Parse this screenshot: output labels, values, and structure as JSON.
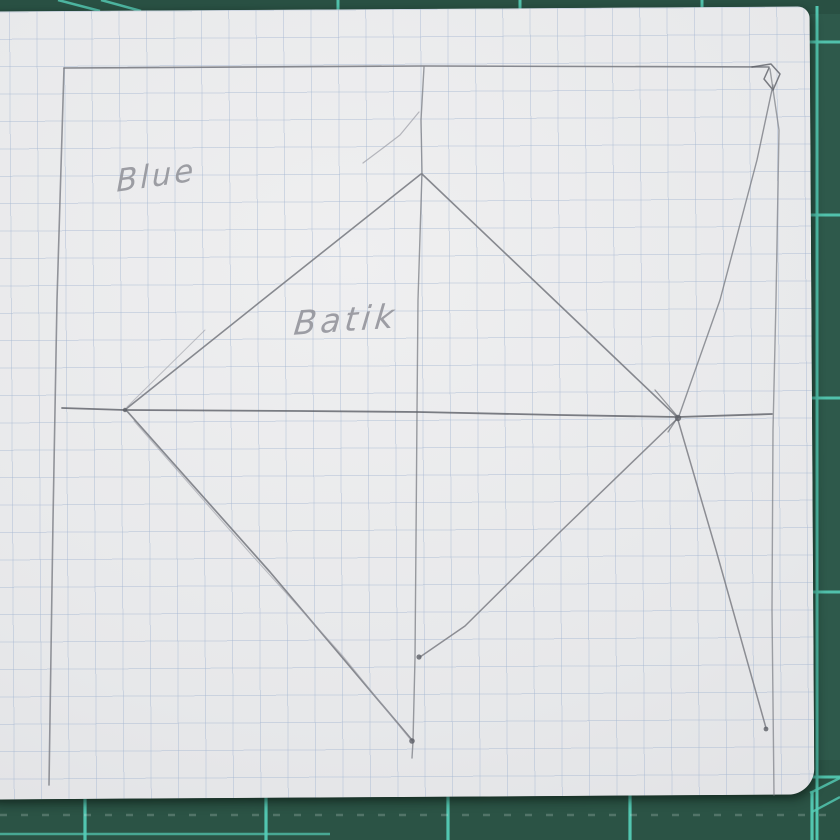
{
  "scene": {
    "width": 840,
    "height": 840,
    "description": "pencil quilt-block sketch on graph paper lying on a green cutting mat"
  },
  "mat": {
    "base_color": "#2e594b",
    "base_dark": "#24483c",
    "grid_line_color": "#55cdb6",
    "top_edge_y": 11,
    "bottom_edge_y": 797,
    "right_edge_x": 812,
    "top_ticks_x": [
      338,
      520,
      702
    ],
    "top_diagonals": [
      [
        58,
        0,
        100,
        11
      ],
      [
        101,
        0,
        141,
        11
      ]
    ],
    "bottom_ticks_x": [
      85,
      266,
      448,
      630,
      812
    ],
    "bottom_line": {
      "y": 834,
      "x1": 0,
      "x2": 330
    },
    "dash_row": {
      "y": 815,
      "x1": 0,
      "x2": 840,
      "color": "rgba(225,235,230,0.22)"
    },
    "right_rail_x": 817,
    "right_ticks_y": [
      42,
      215,
      398,
      592,
      777
    ],
    "corner_diagonals": [
      [
        810,
        793,
        840,
        778
      ],
      [
        812,
        812,
        840,
        797
      ]
    ]
  },
  "paper": {
    "x": -16,
    "y": 9,
    "w": 828,
    "h": 788,
    "rotation_deg": -0.35,
    "radius": "4px 12px 26px 12px",
    "base_color": "#e7e8ea",
    "grid_color": "rgba(163,181,208,0.42)",
    "grid_size_px": 27.4
  },
  "sketch": {
    "tones": {
      "main": "#7b7d84",
      "dark": "#5d5f66",
      "faint": "#9b9da5"
    },
    "labels": [
      {
        "text": "Blue",
        "x": 116,
        "y": 158,
        "size": 31,
        "rot": -8,
        "skew": -8,
        "ls": 3
      },
      {
        "text": "Batik",
        "x": 294,
        "y": 300,
        "size": 33,
        "rot": -4,
        "skew": -10,
        "ls": 4
      }
    ],
    "strokes": [
      {
        "name": "square-top-edge",
        "tone": "main",
        "w": 1.6,
        "o": 0.9,
        "pts": [
          [
            64,
            68
          ],
          [
            424,
            66
          ],
          [
            769,
            67
          ]
        ]
      },
      {
        "name": "square-left-edge",
        "tone": "main",
        "w": 1.6,
        "o": 0.8,
        "pts": [
          [
            64,
            68
          ],
          [
            57,
            300
          ],
          [
            53,
            520
          ],
          [
            49,
            785
          ]
        ]
      },
      {
        "name": "square-right-edge",
        "tone": "main",
        "w": 1.4,
        "o": 0.7,
        "pts": [
          [
            770,
            69
          ],
          [
            779,
            130
          ],
          [
            776,
            300
          ],
          [
            773,
            430
          ],
          [
            772,
            610
          ],
          [
            774,
            795
          ]
        ]
      },
      {
        "name": "corner-loop-scribble",
        "tone": "dark",
        "w": 1.5,
        "o": 0.8,
        "pts": [
          [
            752,
            67
          ],
          [
            771,
            64
          ],
          [
            780,
            74
          ],
          [
            773,
            90
          ],
          [
            764,
            79
          ],
          [
            769,
            68
          ]
        ]
      },
      {
        "name": "center-vertical-line",
        "tone": "main",
        "w": 1.4,
        "o": 0.75,
        "pts": [
          [
            424,
            67
          ],
          [
            421,
            120
          ],
          [
            422,
            172
          ],
          [
            418,
            300
          ],
          [
            417,
            412
          ],
          [
            416,
            540
          ],
          [
            415,
            658
          ],
          [
            413,
            741
          ],
          [
            412,
            758
          ]
        ]
      },
      {
        "name": "center-horizontal-line",
        "tone": "dark",
        "w": 1.8,
        "o": 0.8,
        "pts": [
          [
            62,
            408
          ],
          [
            125,
            410
          ],
          [
            300,
            411
          ],
          [
            418,
            412
          ],
          [
            560,
            415
          ],
          [
            678,
            417
          ],
          [
            772,
            414
          ]
        ]
      },
      {
        "name": "diamond-edge-top-left",
        "tone": "main",
        "w": 1.6,
        "o": 0.9,
        "pts": [
          [
            421,
            174
          ],
          [
            270,
            294
          ],
          [
            126,
            409
          ]
        ]
      },
      {
        "name": "diamond-edge-top-left-ghost",
        "tone": "faint",
        "w": 1.0,
        "o": 0.6,
        "pts": [
          [
            205,
            330
          ],
          [
            127,
            407
          ]
        ]
      },
      {
        "name": "diamond-edge-top-right",
        "tone": "main",
        "w": 1.6,
        "o": 0.9,
        "pts": [
          [
            422,
            174
          ],
          [
            548,
            294
          ],
          [
            676,
            416
          ]
        ]
      },
      {
        "name": "diamond-edge-bottom-left",
        "tone": "main",
        "w": 1.7,
        "o": 0.9,
        "pts": [
          [
            126,
            410
          ],
          [
            270,
            572
          ],
          [
            412,
            740
          ]
        ]
      },
      {
        "name": "diamond-edge-bottom-left-ghost",
        "tone": "faint",
        "w": 1.1,
        "o": 0.6,
        "pts": [
          [
            134,
            421
          ],
          [
            250,
            553
          ],
          [
            342,
            655
          ],
          [
            410,
            739
          ]
        ]
      },
      {
        "name": "diamond-edge-bottom-right",
        "tone": "main",
        "w": 1.5,
        "o": 0.85,
        "pts": [
          [
            677,
            419
          ],
          [
            560,
            532
          ],
          [
            465,
            626
          ],
          [
            420,
            657
          ]
        ]
      },
      {
        "name": "corner-to-center-diagonal-upper",
        "tone": "main",
        "w": 1.4,
        "o": 0.8,
        "pts": [
          [
            773,
            85
          ],
          [
            757,
            160
          ],
          [
            720,
            300
          ],
          [
            679,
            416
          ]
        ]
      },
      {
        "name": "center-to-corner-diagonal-lower",
        "tone": "main",
        "w": 1.5,
        "o": 0.85,
        "pts": [
          [
            678,
            420
          ],
          [
            716,
            550
          ],
          [
            766,
            728
          ]
        ]
      },
      {
        "name": "stray-pencil-arc",
        "tone": "faint",
        "w": 1.2,
        "o": 0.7,
        "pts": [
          [
            419,
            112
          ],
          [
            400,
            135
          ],
          [
            383,
            148
          ],
          [
            363,
            163
          ]
        ]
      },
      {
        "name": "right-vertex-scribble",
        "tone": "dark",
        "w": 1.3,
        "o": 0.6,
        "pts": [
          [
            655,
            390
          ],
          [
            678,
            417
          ],
          [
            668,
            432
          ]
        ]
      }
    ],
    "dots": [
      {
        "name": "pencil-dot-mid-vertical",
        "x": 419,
        "y": 657,
        "r": 2.6
      },
      {
        "name": "pencil-dot-bottom-vertex",
        "x": 412,
        "y": 741,
        "r": 2.8
      },
      {
        "name": "pencil-dot-right-vertex",
        "x": 678,
        "y": 418,
        "r": 3.2
      },
      {
        "name": "pencil-dot-line-end",
        "x": 766,
        "y": 729,
        "r": 2.4
      },
      {
        "name": "pencil-dot-left-vertex",
        "x": 125,
        "y": 410,
        "r": 2.2
      }
    ]
  }
}
